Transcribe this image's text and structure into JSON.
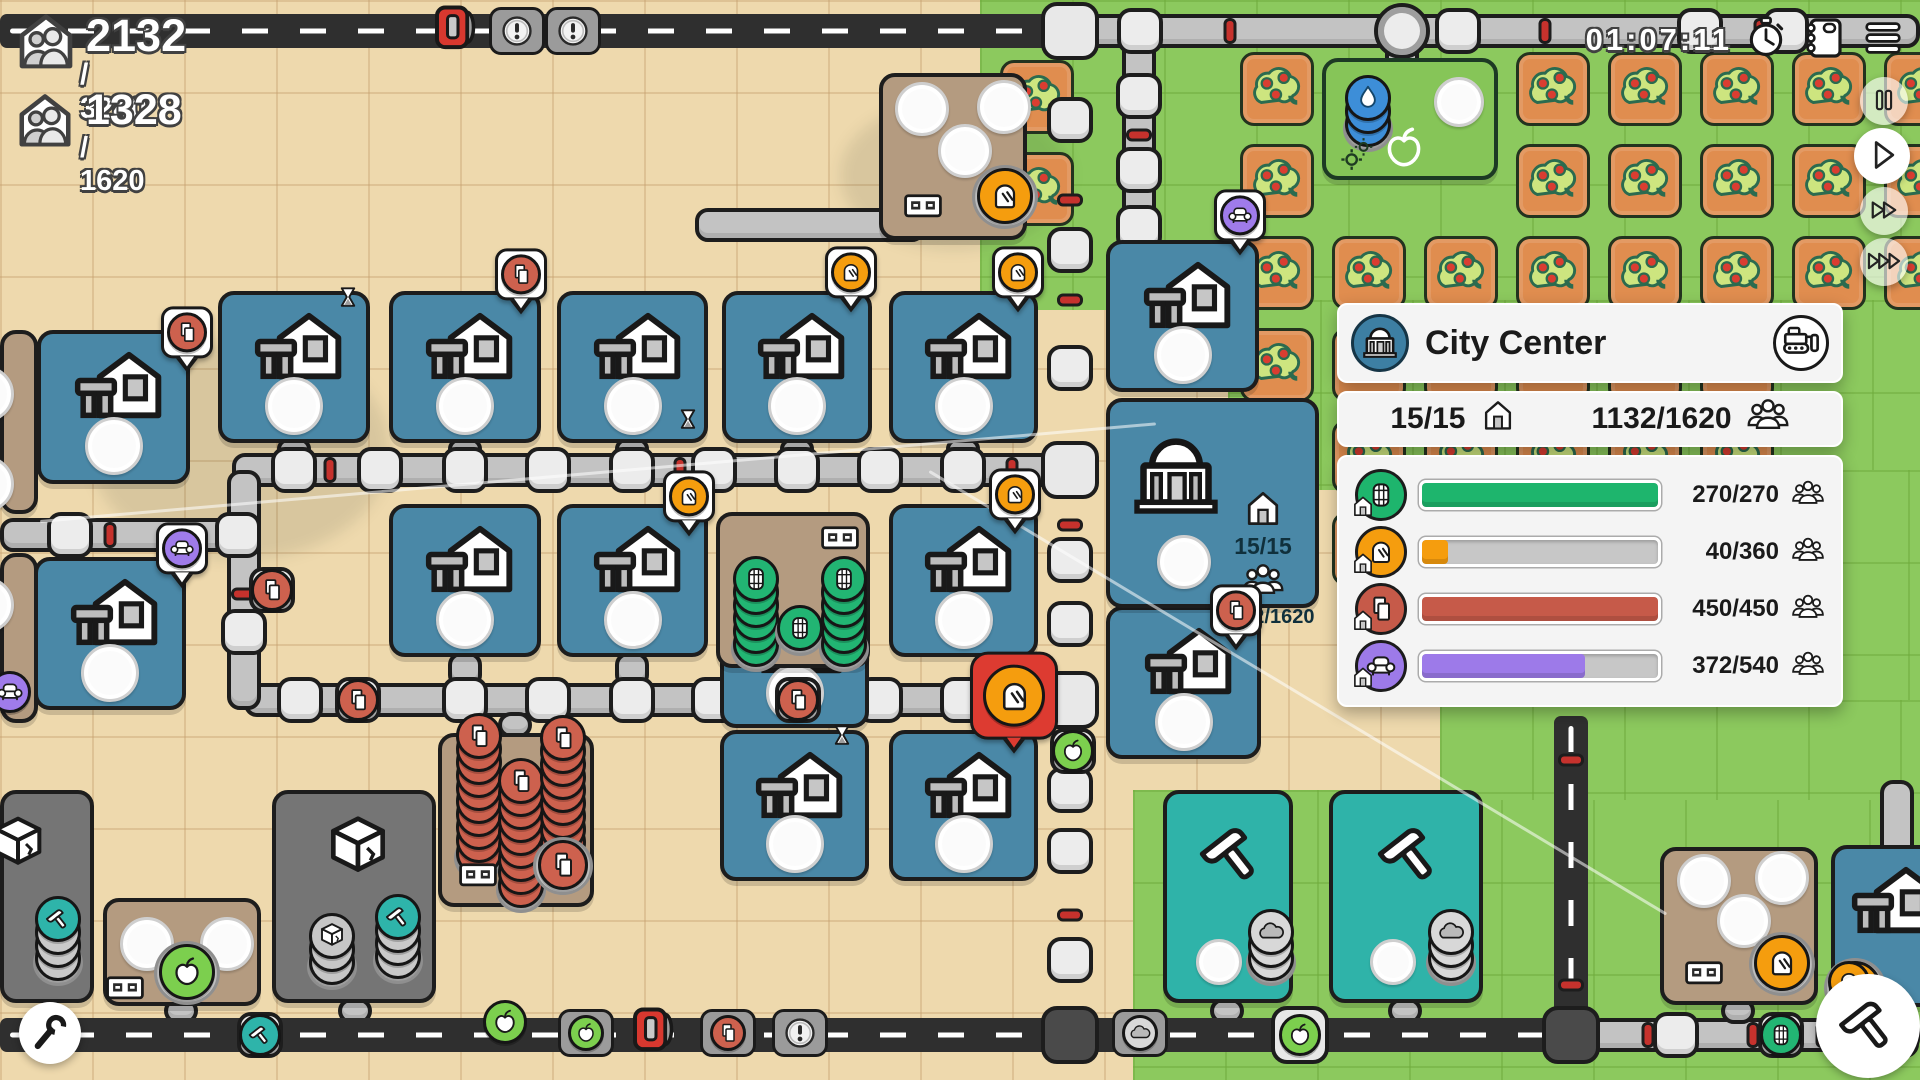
{
  "hud": {
    "population": {
      "value": "2132",
      "max": "/ 3240"
    },
    "housing": {
      "value": "1328",
      "max": "/ 1620"
    },
    "timer": "01:07:11"
  },
  "controls": {
    "speed": [
      "pause",
      "play",
      "fast-forward",
      "fastest-forward"
    ],
    "top_right": [
      "journal",
      "menu"
    ],
    "corner_tools": [
      "settings-wrench",
      "build-hammer"
    ]
  },
  "panel": {
    "title": "City Center",
    "houses": "15/15",
    "population": "1132/1620",
    "rows": [
      {
        "icon": "barrel",
        "color": "#1eb56d",
        "value": 270,
        "max": 270,
        "label": "270/270"
      },
      {
        "icon": "bread",
        "color": "#f59d0e",
        "value": 40,
        "max": 360,
        "label": "40/360"
      },
      {
        "icon": "paper",
        "color": "#c65a49",
        "value": 450,
        "max": 450,
        "label": "450/450"
      },
      {
        "icon": "couch",
        "color": "#9d7ae9",
        "value": 372,
        "max": 540,
        "label": "372/540"
      }
    ]
  },
  "map": {
    "city_tile": {
      "houses": "15/15",
      "population": "1132/1620"
    },
    "palette": {
      "sand": "#eed9ad",
      "grass": "#8cc95e",
      "road": "#c3c3c3",
      "highway": "#2f2f2f",
      "house_tile": "#4a88a7",
      "brown_tile": "#b49b80",
      "gray_tile": "#757575",
      "teal_tile": "#2fb3a9",
      "fruit_tile": "#e08d4f",
      "barrel": "#22b573",
      "bread": "#f59d0e",
      "paper": "#cd614e",
      "couch": "#9f7bea",
      "apple": "#7ccf4e",
      "water": "#3d8ed8"
    },
    "greens": [
      [
        980,
        0,
        940,
        310
      ],
      [
        1228,
        300,
        692,
        190
      ],
      [
        1540,
        470,
        380,
        330
      ],
      [
        1133,
        790,
        787,
        290
      ],
      [
        1440,
        700,
        480,
        100
      ]
    ],
    "orchard": {
      "ox": 1240,
      "oy": 52,
      "pitch": 92,
      "size": 74,
      "cols": 8,
      "rows": 6,
      "skip": [
        [
          1,
          0
        ],
        [
          2,
          0
        ],
        [
          1,
          1
        ],
        [
          2,
          1
        ],
        [
          6,
          3
        ],
        [
          7,
          3
        ],
        [
          6,
          4
        ],
        [
          7,
          4
        ],
        [
          6,
          5
        ],
        [
          7,
          5
        ]
      ],
      "extra": [
        [
          1000,
          60
        ],
        [
          1000,
          152
        ]
      ]
    },
    "gray_roads": [
      [
        1053,
        14,
        867,
        34
      ],
      [
        0,
        518,
        252,
        34
      ],
      [
        232,
        453,
        855,
        34
      ],
      [
        244,
        683,
        843,
        34
      ],
      [
        227,
        470,
        34,
        240
      ],
      [
        1122,
        31,
        34,
        226
      ],
      [
        1385,
        31,
        34,
        48
      ],
      [
        695,
        208,
        230,
        34
      ],
      [
        1588,
        1018,
        332,
        34
      ],
      [
        1880,
        780,
        34,
        248
      ],
      [
        277,
        438,
        34,
        22
      ],
      [
        448,
        438,
        34,
        22
      ],
      [
        615,
        438,
        34,
        22
      ],
      [
        780,
        438,
        34,
        22
      ],
      [
        946,
        438,
        34,
        22
      ],
      [
        448,
        652,
        34,
        36
      ],
      [
        615,
        652,
        34,
        36
      ],
      [
        780,
        652,
        34,
        36
      ],
      [
        1210,
        998,
        34,
        26
      ],
      [
        1388,
        998,
        34,
        26
      ],
      [
        164,
        998,
        34,
        26
      ],
      [
        338,
        998,
        34,
        26
      ],
      [
        498,
        712,
        34,
        26
      ],
      [
        1721,
        998,
        34,
        26
      ],
      [
        1858,
        998,
        34,
        20
      ]
    ],
    "highways": [
      [
        0,
        14,
        1087,
        34
      ],
      [
        0,
        1018,
        1588,
        34
      ],
      [
        1554,
        716,
        34,
        336
      ]
    ],
    "junctions": [
      [
        1070,
        31,
        0
      ],
      [
        1070,
        470,
        0
      ],
      [
        1070,
        700,
        0
      ],
      [
        1070,
        1035,
        1
      ],
      [
        1571,
        1035,
        1
      ],
      [
        1300,
        1035,
        0
      ],
      [
        1402,
        31,
        2
      ]
    ],
    "nodes": [
      [
        294,
        470
      ],
      [
        380,
        470
      ],
      [
        465,
        470
      ],
      [
        548,
        470
      ],
      [
        632,
        470
      ],
      [
        714,
        470
      ],
      [
        797,
        470
      ],
      [
        880,
        470
      ],
      [
        963,
        470
      ],
      [
        300,
        700
      ],
      [
        465,
        700
      ],
      [
        548,
        700
      ],
      [
        632,
        700
      ],
      [
        714,
        700
      ],
      [
        880,
        700
      ],
      [
        963,
        700
      ],
      [
        1070,
        120
      ],
      [
        1070,
        250
      ],
      [
        1070,
        368
      ],
      [
        1070,
        560
      ],
      [
        1070,
        624
      ],
      [
        1070,
        790
      ],
      [
        1070,
        851
      ],
      [
        1070,
        960
      ],
      [
        1140,
        31
      ],
      [
        1458,
        31
      ],
      [
        1700,
        31
      ],
      [
        1786,
        31
      ],
      [
        70,
        535
      ],
      [
        238,
        535
      ],
      [
        244,
        632
      ],
      [
        1139,
        96
      ],
      [
        1139,
        170
      ],
      [
        1139,
        228
      ],
      [
        1676,
        1035
      ],
      [
        1896,
        1035
      ],
      [
        1897,
        905
      ]
    ],
    "nubs": [
      [
        330,
        470,
        "h"
      ],
      [
        680,
        470,
        "h"
      ],
      [
        1012,
        470,
        "h"
      ],
      [
        345,
        700,
        "h"
      ],
      [
        760,
        700,
        "h"
      ],
      [
        1012,
        700,
        "h"
      ],
      [
        110,
        535,
        "h"
      ],
      [
        244,
        594,
        "v"
      ],
      [
        1070,
        200,
        "v"
      ],
      [
        1070,
        300,
        "v"
      ],
      [
        1070,
        525,
        "v"
      ],
      [
        1070,
        745,
        "v"
      ],
      [
        1070,
        915,
        "v"
      ],
      [
        1139,
        135,
        "v"
      ],
      [
        1230,
        31,
        "h"
      ],
      [
        1545,
        31,
        "h"
      ],
      [
        1760,
        31,
        "h"
      ],
      [
        1648,
        1035,
        "h"
      ],
      [
        1753,
        1035,
        "h"
      ],
      [
        1822,
        1035,
        "h"
      ],
      [
        1571,
        760,
        "v"
      ],
      [
        1571,
        985,
        "v"
      ]
    ],
    "tiles": [
      {
        "t": "house",
        "x": 218,
        "y": 291,
        "w": 152,
        "h": 152
      },
      {
        "t": "house",
        "x": 389,
        "y": 291,
        "w": 152,
        "h": 152
      },
      {
        "t": "house",
        "x": 557,
        "y": 291,
        "w": 151,
        "h": 152
      },
      {
        "t": "house",
        "x": 722,
        "y": 291,
        "w": 150,
        "h": 152
      },
      {
        "t": "house",
        "x": 889,
        "y": 291,
        "w": 149,
        "h": 152
      },
      {
        "t": "house",
        "x": 37,
        "y": 330,
        "w": 153,
        "h": 154
      },
      {
        "t": "house",
        "x": 1106,
        "y": 240,
        "w": 153,
        "h": 152
      },
      {
        "t": "house",
        "x": 389,
        "y": 504,
        "w": 152,
        "h": 153
      },
      {
        "t": "house",
        "x": 557,
        "y": 504,
        "w": 151,
        "h": 153
      },
      {
        "t": "house",
        "x": 889,
        "y": 504,
        "w": 149,
        "h": 153
      },
      {
        "t": "house",
        "x": 34,
        "y": 557,
        "w": 152,
        "h": 153
      },
      {
        "t": "house",
        "x": 720,
        "y": 585,
        "w": 149,
        "h": 143
      },
      {
        "t": "house",
        "x": 1106,
        "y": 606,
        "w": 155,
        "h": 153
      },
      {
        "t": "house",
        "x": 720,
        "y": 730,
        "w": 149,
        "h": 151
      },
      {
        "t": "house",
        "x": 889,
        "y": 730,
        "w": 149,
        "h": 151
      },
      {
        "t": "house",
        "x": 1831,
        "y": 845,
        "w": 120,
        "h": 162,
        "cut": 1,
        "disc": [
          "bread",
          20,
          138
        ]
      },
      {
        "t": "city",
        "x": 1106,
        "y": 398,
        "w": 213,
        "h": 210,
        "slot": [
          74,
          160
        ]
      },
      {
        "t": "bakery",
        "x": 879,
        "y": 73,
        "w": 148,
        "h": 167,
        "slots": [
          [
            39,
            32
          ],
          [
            121,
            30
          ],
          [
            82,
            74
          ]
        ],
        "machine": [
          40,
          123
        ],
        "disc": [
          "bread",
          122,
          119
        ]
      },
      {
        "t": "bakery",
        "x": 1660,
        "y": 847,
        "w": 158,
        "h": 158,
        "slots": [
          [
            40,
            30
          ],
          [
            118,
            27
          ],
          [
            80,
            70
          ]
        ],
        "machine": [
          40,
          116
        ],
        "disc": [
          "bread",
          118,
          112
        ]
      },
      {
        "t": "sbarrel",
        "x": 716,
        "y": 512,
        "w": 154,
        "h": 156,
        "stacks": [
          {
            "x": 36,
            "b": 128,
            "n": 6,
            "c": "barrel"
          },
          {
            "x": 80,
            "b": 112,
            "n": 1,
            "c": "barrel"
          },
          {
            "x": 124,
            "b": 128,
            "n": 6,
            "c": "barrel"
          }
        ],
        "machine": [
          120,
          16
        ]
      },
      {
        "t": "spaper",
        "x": 438,
        "y": 733,
        "w": 156,
        "h": 174,
        "stacks": [
          {
            "x": 37,
            "b": 116,
            "n": 10,
            "c": "paper"
          },
          {
            "x": 79,
            "b": 148,
            "n": 9,
            "c": "paper"
          },
          {
            "x": 121,
            "b": 118,
            "n": 10,
            "c": "paper"
          }
        ],
        "machine": [
          36,
          132
        ],
        "disc": [
          "paper",
          121,
          128
        ]
      },
      {
        "t": "stone",
        "x": 0,
        "y": 790,
        "w": 94,
        "h": 213,
        "cube": [
          14,
          50,
          64
        ],
        "stacks": [
          {
            "x": 54,
            "b": 164,
            "n": 4,
            "c": "hammer"
          }
        ]
      },
      {
        "t": "stone",
        "x": 272,
        "y": 790,
        "w": 164,
        "h": 213,
        "cube": [
          82,
          54,
          74
        ],
        "stacks": [
          {
            "x": 56,
            "b": 168,
            "n": 3,
            "c": "cube"
          },
          {
            "x": 122,
            "b": 162,
            "n": 4,
            "c": "hammer"
          }
        ]
      },
      {
        "t": "press",
        "x": 103,
        "y": 898,
        "w": 158,
        "h": 108,
        "slots": [
          [
            40,
            42
          ],
          [
            120,
            42
          ]
        ],
        "machine": [
          18,
          80
        ],
        "disc": [
          "apple",
          80,
          70
        ]
      },
      {
        "t": "workshop",
        "x": 1163,
        "y": 790,
        "w": 130,
        "h": 213,
        "slot": [
          52,
          168
        ],
        "stack": {
          "x": 104,
          "b": 164,
          "n": 3,
          "c": "cloud"
        }
      },
      {
        "t": "workshop",
        "x": 1329,
        "y": 790,
        "w": 154,
        "h": 213,
        "slot": [
          60,
          168
        ],
        "stack": {
          "x": 118,
          "b": 164,
          "n": 3,
          "c": "cloud"
        }
      },
      {
        "t": "well",
        "x": 1322,
        "y": 58,
        "w": 176,
        "h": 122,
        "stack": {
          "x": 42,
          "b": 62,
          "n": 3,
          "c": "drop"
        },
        "slot": [
          133,
          40
        ],
        "apple": [
          78,
          86
        ],
        "gears": [
          32,
          92
        ]
      },
      {
        "t": "brownstrip",
        "x": 0,
        "y": 330,
        "w": 38,
        "h": 184,
        "slots": [
          [
            -18,
            60
          ],
          [
            -18,
            150
          ]
        ]
      },
      {
        "t": "brownstrip",
        "x": 0,
        "y": 553,
        "w": 38,
        "h": 170,
        "slots": [
          [
            -18,
            48
          ]
        ]
      }
    ],
    "vehicles": [
      {
        "t": "truck",
        "x": 458,
        "y": 31
      },
      {
        "t": "bang",
        "x": 517,
        "y": 31
      },
      {
        "t": "bang",
        "x": 573,
        "y": 31
      },
      {
        "t": "apple",
        "x": 505,
        "y": 1022,
        "plain": 1
      },
      {
        "t": "apple",
        "x": 586,
        "y": 1033
      },
      {
        "t": "truck",
        "x": 656,
        "y": 1033
      },
      {
        "t": "paper",
        "x": 728,
        "y": 1033
      },
      {
        "t": "bang",
        "x": 800,
        "y": 1033
      },
      {
        "t": "cloud",
        "x": 1140,
        "y": 1033
      }
    ],
    "discs": [
      {
        "t": "couch",
        "x": 10,
        "y": 692
      },
      {
        "t": "paper",
        "x": 272,
        "y": 590,
        "n": 1
      },
      {
        "t": "paper",
        "x": 358,
        "y": 700,
        "n": 1
      },
      {
        "t": "paper",
        "x": 798,
        "y": 700,
        "n": 1
      },
      {
        "t": "apple",
        "x": 1073,
        "y": 751,
        "n": 1
      },
      {
        "t": "hammer",
        "x": 260,
        "y": 1035,
        "n": 1
      },
      {
        "t": "barrel",
        "x": 1781,
        "y": 1035,
        "n": 1
      },
      {
        "t": "bread",
        "x": 1849,
        "y": 982
      },
      {
        "t": "apple",
        "x": 1300,
        "y": 1035
      }
    ],
    "pins": [
      {
        "t": "paper",
        "x": 187,
        "y": 348
      },
      {
        "t": "paper",
        "x": 521,
        "y": 290
      },
      {
        "t": "bread",
        "x": 851,
        "y": 288
      },
      {
        "t": "bread",
        "x": 1018,
        "y": 288
      },
      {
        "t": "bread",
        "x": 689,
        "y": 512
      },
      {
        "t": "bread",
        "x": 1015,
        "y": 510
      },
      {
        "t": "couch",
        "x": 1240,
        "y": 231
      },
      {
        "t": "couch",
        "x": 182,
        "y": 564
      },
      {
        "t": "paper",
        "x": 1236,
        "y": 626
      },
      {
        "t": "bread",
        "x": 1014,
        "y": 722,
        "sel": 1
      }
    ],
    "badges": [
      [
        348,
        302
      ],
      [
        688,
        424
      ],
      [
        842,
        740
      ]
    ],
    "shadows": [
      [
        90,
        340,
        300,
        220
      ],
      [
        840,
        100,
        230,
        150
      ]
    ],
    "trails": [
      [
        40,
        520,
        1120,
        -5
      ],
      [
        930,
        470,
        860,
        31
      ]
    ]
  }
}
